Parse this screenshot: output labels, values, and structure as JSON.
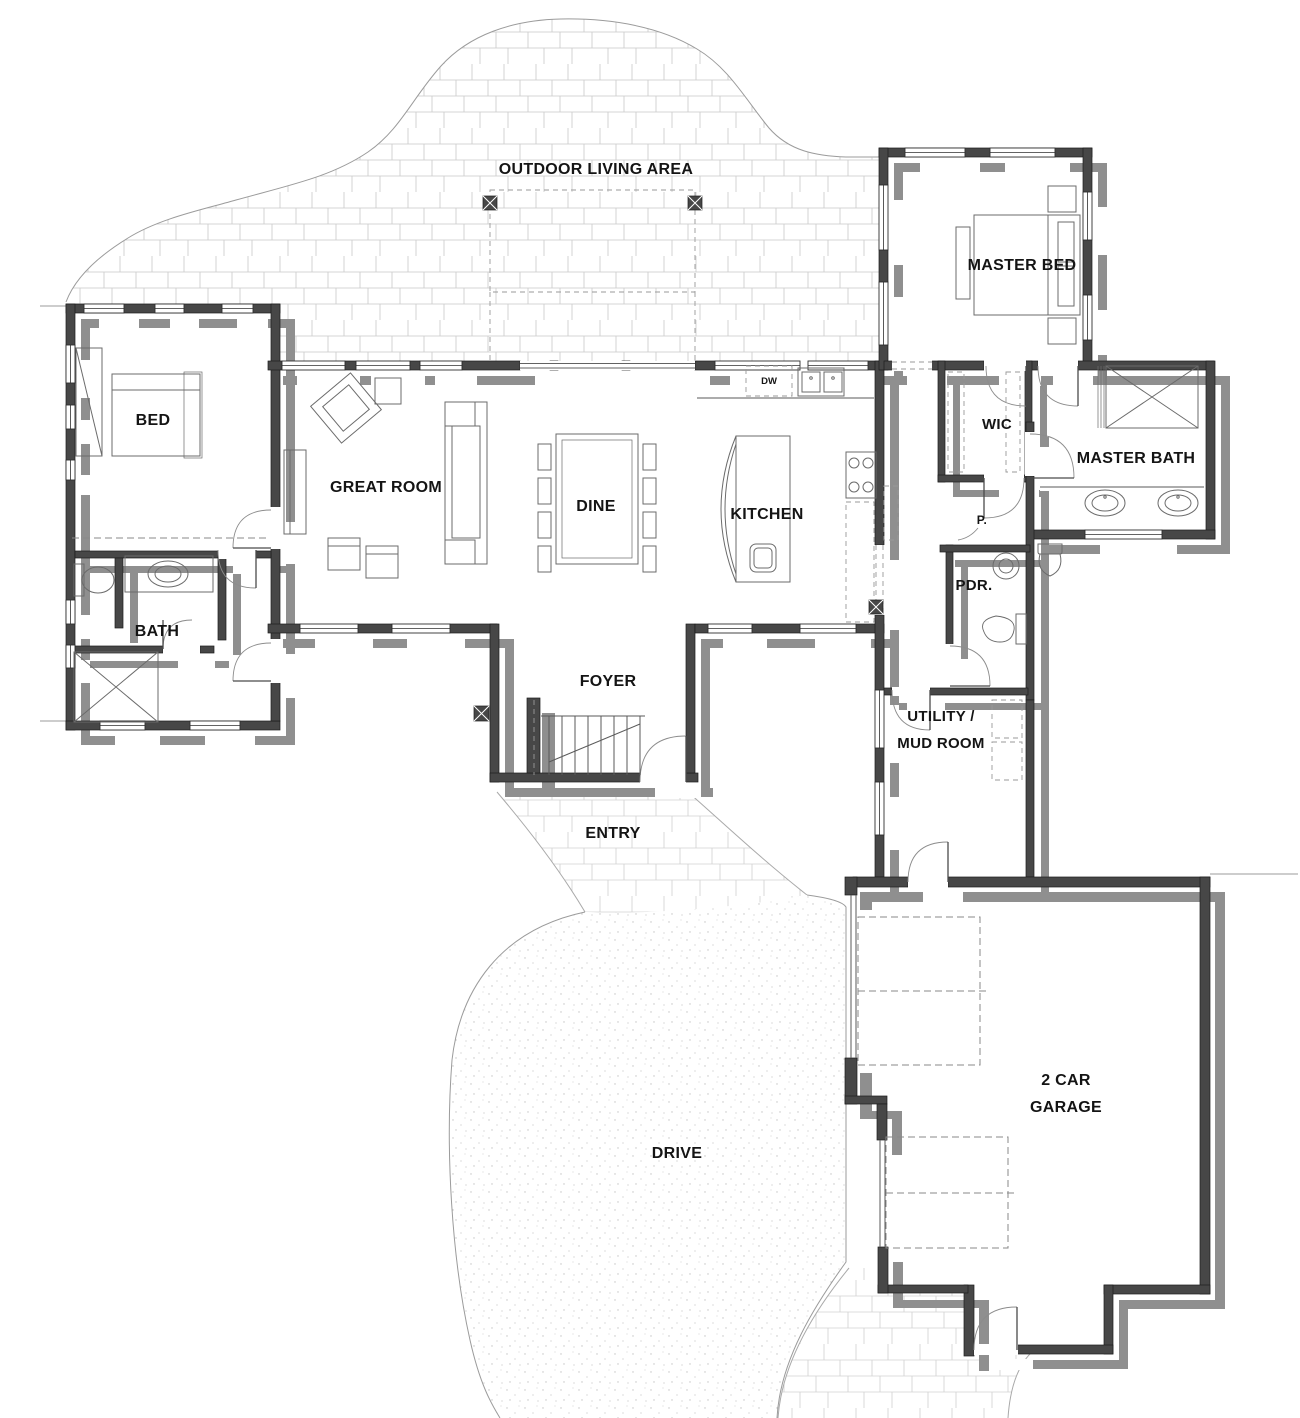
{
  "plan": {
    "title": "Single-story house floor plan",
    "colors": {
      "wall": "#474747",
      "shadow": "#8f8f8f",
      "text": "#141414",
      "hatch": "#c9c9c9",
      "stipple": "#c4c4c4"
    },
    "rooms": {
      "outdoor": "OUTDOOR LIVING AREA",
      "master_bed": "MASTER BED",
      "bed": "BED",
      "great_room": "GREAT ROOM",
      "dine": "DINE",
      "kitchen": "KITCHEN",
      "wic": "WIC",
      "master_bath": "MASTER BATH",
      "bath": "BATH",
      "pdr": "PDR.",
      "pantry": "P.",
      "foyer": "FOYER",
      "entry": "ENTRY",
      "utility_line1": "UTILITY /",
      "utility_line2": "MUD ROOM",
      "drive": "DRIVE",
      "garage_line1": "2 CAR",
      "garage_line2": "GARAGE",
      "dishwasher": "DW"
    }
  }
}
